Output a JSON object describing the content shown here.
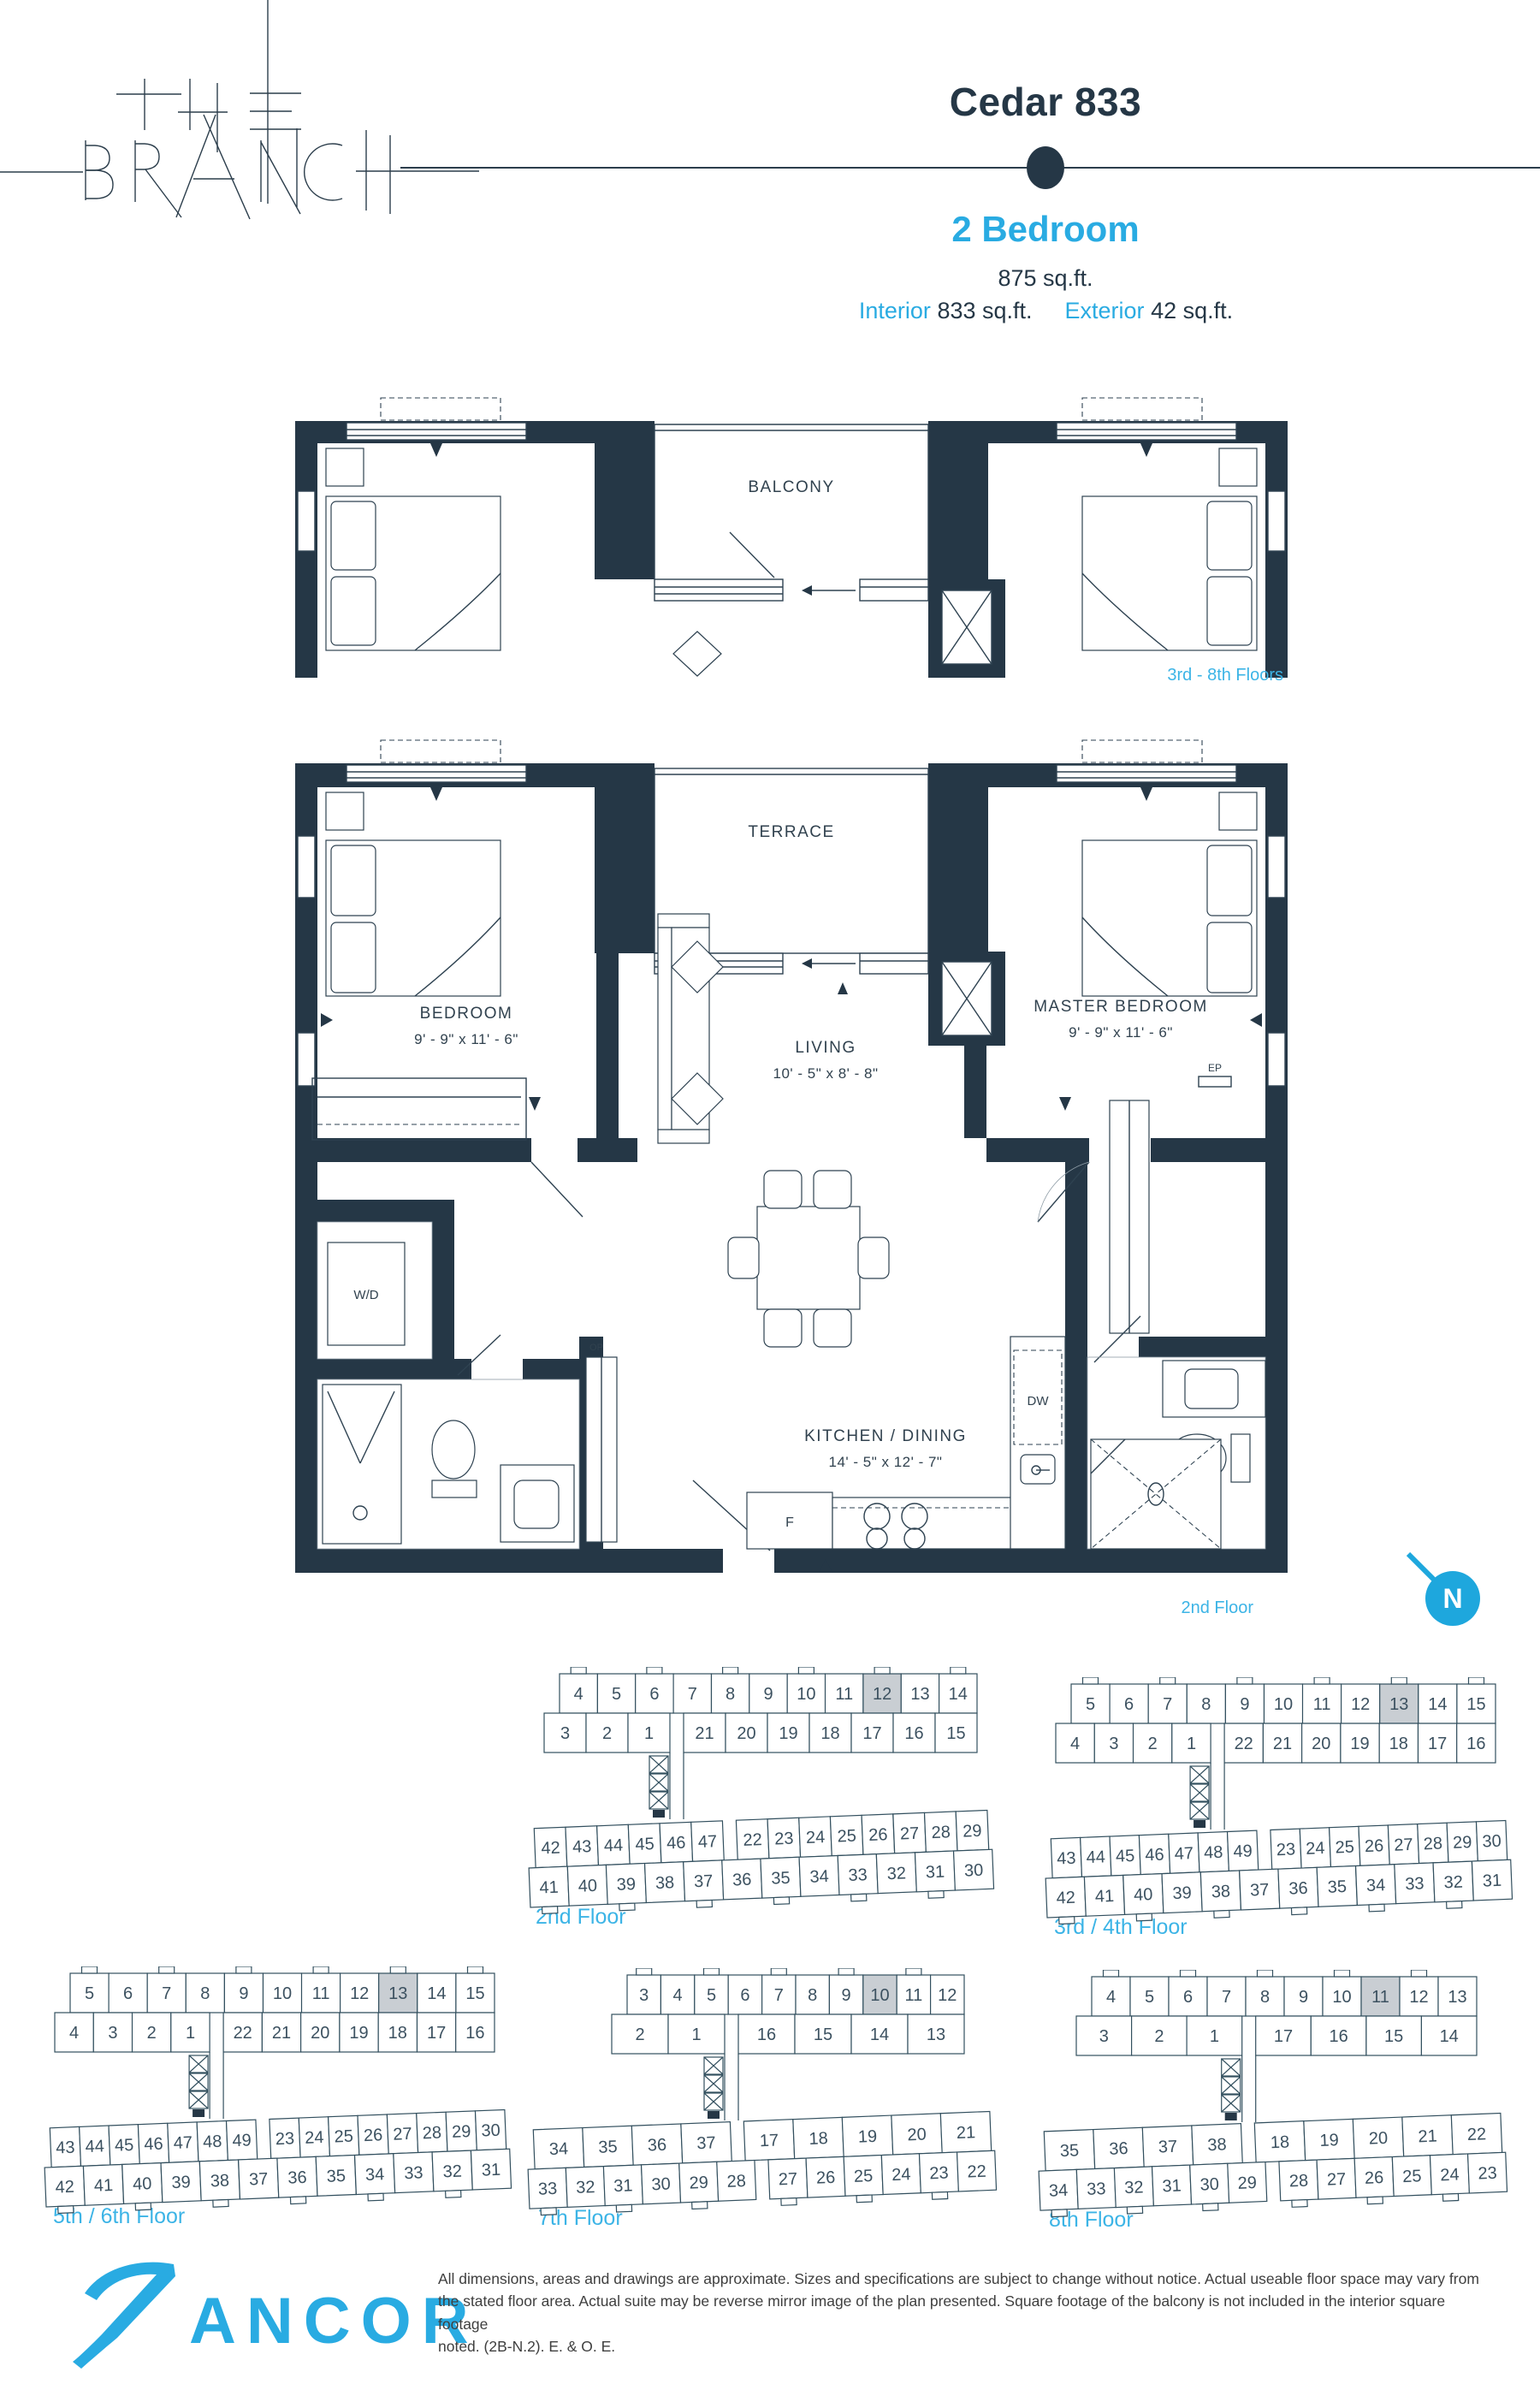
{
  "header": {
    "brand_line1": "THE",
    "brand_line2": "BRANCH",
    "title": "Cedar 833",
    "unit_type": "2 Bedroom",
    "total_area": "875 sq.ft.",
    "interior_label": "Interior",
    "interior_area": "833 sq.ft.",
    "exterior_label": "Exterior",
    "exterior_area": "42 sq.ft."
  },
  "colors": {
    "navy": "#253746",
    "blue": "#29abe2",
    "light_blue": "#3cb4e6",
    "highlight": "#c9ced3"
  },
  "upper_plan": {
    "balcony": "BALCONY",
    "floors_label": "3rd - 8th Floors"
  },
  "main_plan": {
    "terrace": "TERRACE",
    "bedroom": "BEDROOM",
    "bedroom_dims": "9' - 9\" x 11' - 6\"",
    "master_bedroom": "MASTER BEDROOM",
    "master_dims": "9' - 9\" x 11' - 6\"",
    "living": "LIVING",
    "living_dims": "10' - 5\" x 8' - 8\"",
    "kitchen": "KITCHEN / DINING",
    "kitchen_dims": "14' - 5\" x 12' - 7\"",
    "wd": "W/D",
    "dw": "DW",
    "fridge": "F",
    "op": "OP",
    "ep": "EP",
    "floor_label": "2nd Floor",
    "north": "N"
  },
  "keyplans": [
    {
      "label": "2nd Floor",
      "highlight": "12",
      "top_row1": [
        [
          "4",
          "5",
          "6",
          "7",
          "8",
          "9",
          "10",
          "11",
          "12",
          "13",
          "14"
        ]
      ],
      "top_row2": [
        [
          "3",
          "2",
          "1"
        ],
        [
          "21",
          "20",
          "19",
          "18",
          "17",
          "16",
          "15"
        ]
      ],
      "bottom_row1": [
        [
          "42",
          "43",
          "44",
          "45",
          "46",
          "47"
        ],
        [
          "22",
          "23",
          "24",
          "25",
          "26",
          "27",
          "28",
          "29"
        ]
      ],
      "bottom_row2": [
        [
          "41",
          "40",
          "39",
          "38",
          "37",
          "36",
          "35",
          "34",
          "33",
          "32",
          "31",
          "30"
        ]
      ]
    },
    {
      "label": "3rd / 4th Floor",
      "highlight": "13",
      "top_row1": [
        [
          "5",
          "6",
          "7",
          "8",
          "9",
          "10",
          "11",
          "12",
          "13",
          "14",
          "15"
        ]
      ],
      "top_row2": [
        [
          "4",
          "3",
          "2",
          "1"
        ],
        [
          "22",
          "21",
          "20",
          "19",
          "18",
          "17",
          "16"
        ]
      ],
      "bottom_row1": [
        [
          "43",
          "44",
          "45",
          "46",
          "47",
          "48",
          "49"
        ],
        [
          "23",
          "24",
          "25",
          "26",
          "27",
          "28",
          "29",
          "30"
        ]
      ],
      "bottom_row2": [
        [
          "42",
          "41",
          "40",
          "39",
          "38",
          "37",
          "36",
          "35",
          "34",
          "33",
          "32",
          "31"
        ]
      ]
    },
    {
      "label": "5th / 6th Floor",
      "highlight": "13",
      "top_row1": [
        [
          "5",
          "6",
          "7",
          "8",
          "9",
          "10",
          "11",
          "12",
          "13",
          "14",
          "15"
        ]
      ],
      "top_row2": [
        [
          "4",
          "3",
          "2",
          "1"
        ],
        [
          "22",
          "21",
          "20",
          "19",
          "18",
          "17",
          "16"
        ]
      ],
      "bottom_row1": [
        [
          "43",
          "44",
          "45",
          "46",
          "47",
          "48",
          "49"
        ],
        [
          "23",
          "24",
          "25",
          "26",
          "27",
          "28",
          "29",
          "30"
        ]
      ],
      "bottom_row2": [
        [
          "42",
          "41",
          "40",
          "39",
          "38",
          "37",
          "36",
          "35",
          "34",
          "33",
          "32",
          "31"
        ]
      ]
    },
    {
      "label": "7th Floor",
      "highlight": "10",
      "top_row1": [
        [
          "3",
          "4",
          "5",
          "6",
          "7",
          "8",
          "9",
          "10",
          "11",
          "12"
        ]
      ],
      "top_row2": [
        [
          "2",
          "1"
        ],
        [
          "16",
          "15",
          "14",
          "13"
        ]
      ],
      "bottom_row1": [
        [
          "34",
          "35",
          "36",
          "37"
        ],
        [
          "17",
          "18",
          "19",
          "20",
          "21"
        ]
      ],
      "bottom_row2": [
        [
          "33",
          "32",
          "31",
          "30",
          "29",
          "28"
        ],
        [
          "27",
          "26",
          "25",
          "24",
          "23",
          "22"
        ]
      ]
    },
    {
      "label": "8th Floor",
      "highlight": "11",
      "top_row1": [
        [
          "4",
          "5",
          "6",
          "7",
          "8",
          "9",
          "10",
          "11",
          "12",
          "13"
        ]
      ],
      "top_row2": [
        [
          "3",
          "2",
          "1"
        ],
        [
          "17",
          "16",
          "15",
          "14"
        ]
      ],
      "bottom_row1": [
        [
          "35",
          "36",
          "37",
          "38"
        ],
        [
          "18",
          "19",
          "20",
          "21",
          "22"
        ]
      ],
      "bottom_row2": [
        [
          "34",
          "33",
          "32",
          "31",
          "30",
          "29"
        ],
        [
          "28",
          "27",
          "26",
          "25",
          "24",
          "23"
        ]
      ]
    }
  ],
  "footer": {
    "logo_text": "ANCOR",
    "disclaimer_line1": "All dimensions, areas and drawings are approximate. Sizes and specifications are subject to change without notice. Actual useable floor space may vary from",
    "disclaimer_line2": "the stated floor area. Actual suite may be reverse mirror image of the plan presented. Square footage of the balcony is not included in the interior square footage",
    "disclaimer_line3": "noted. (2B-N.2). E. & O. E."
  }
}
